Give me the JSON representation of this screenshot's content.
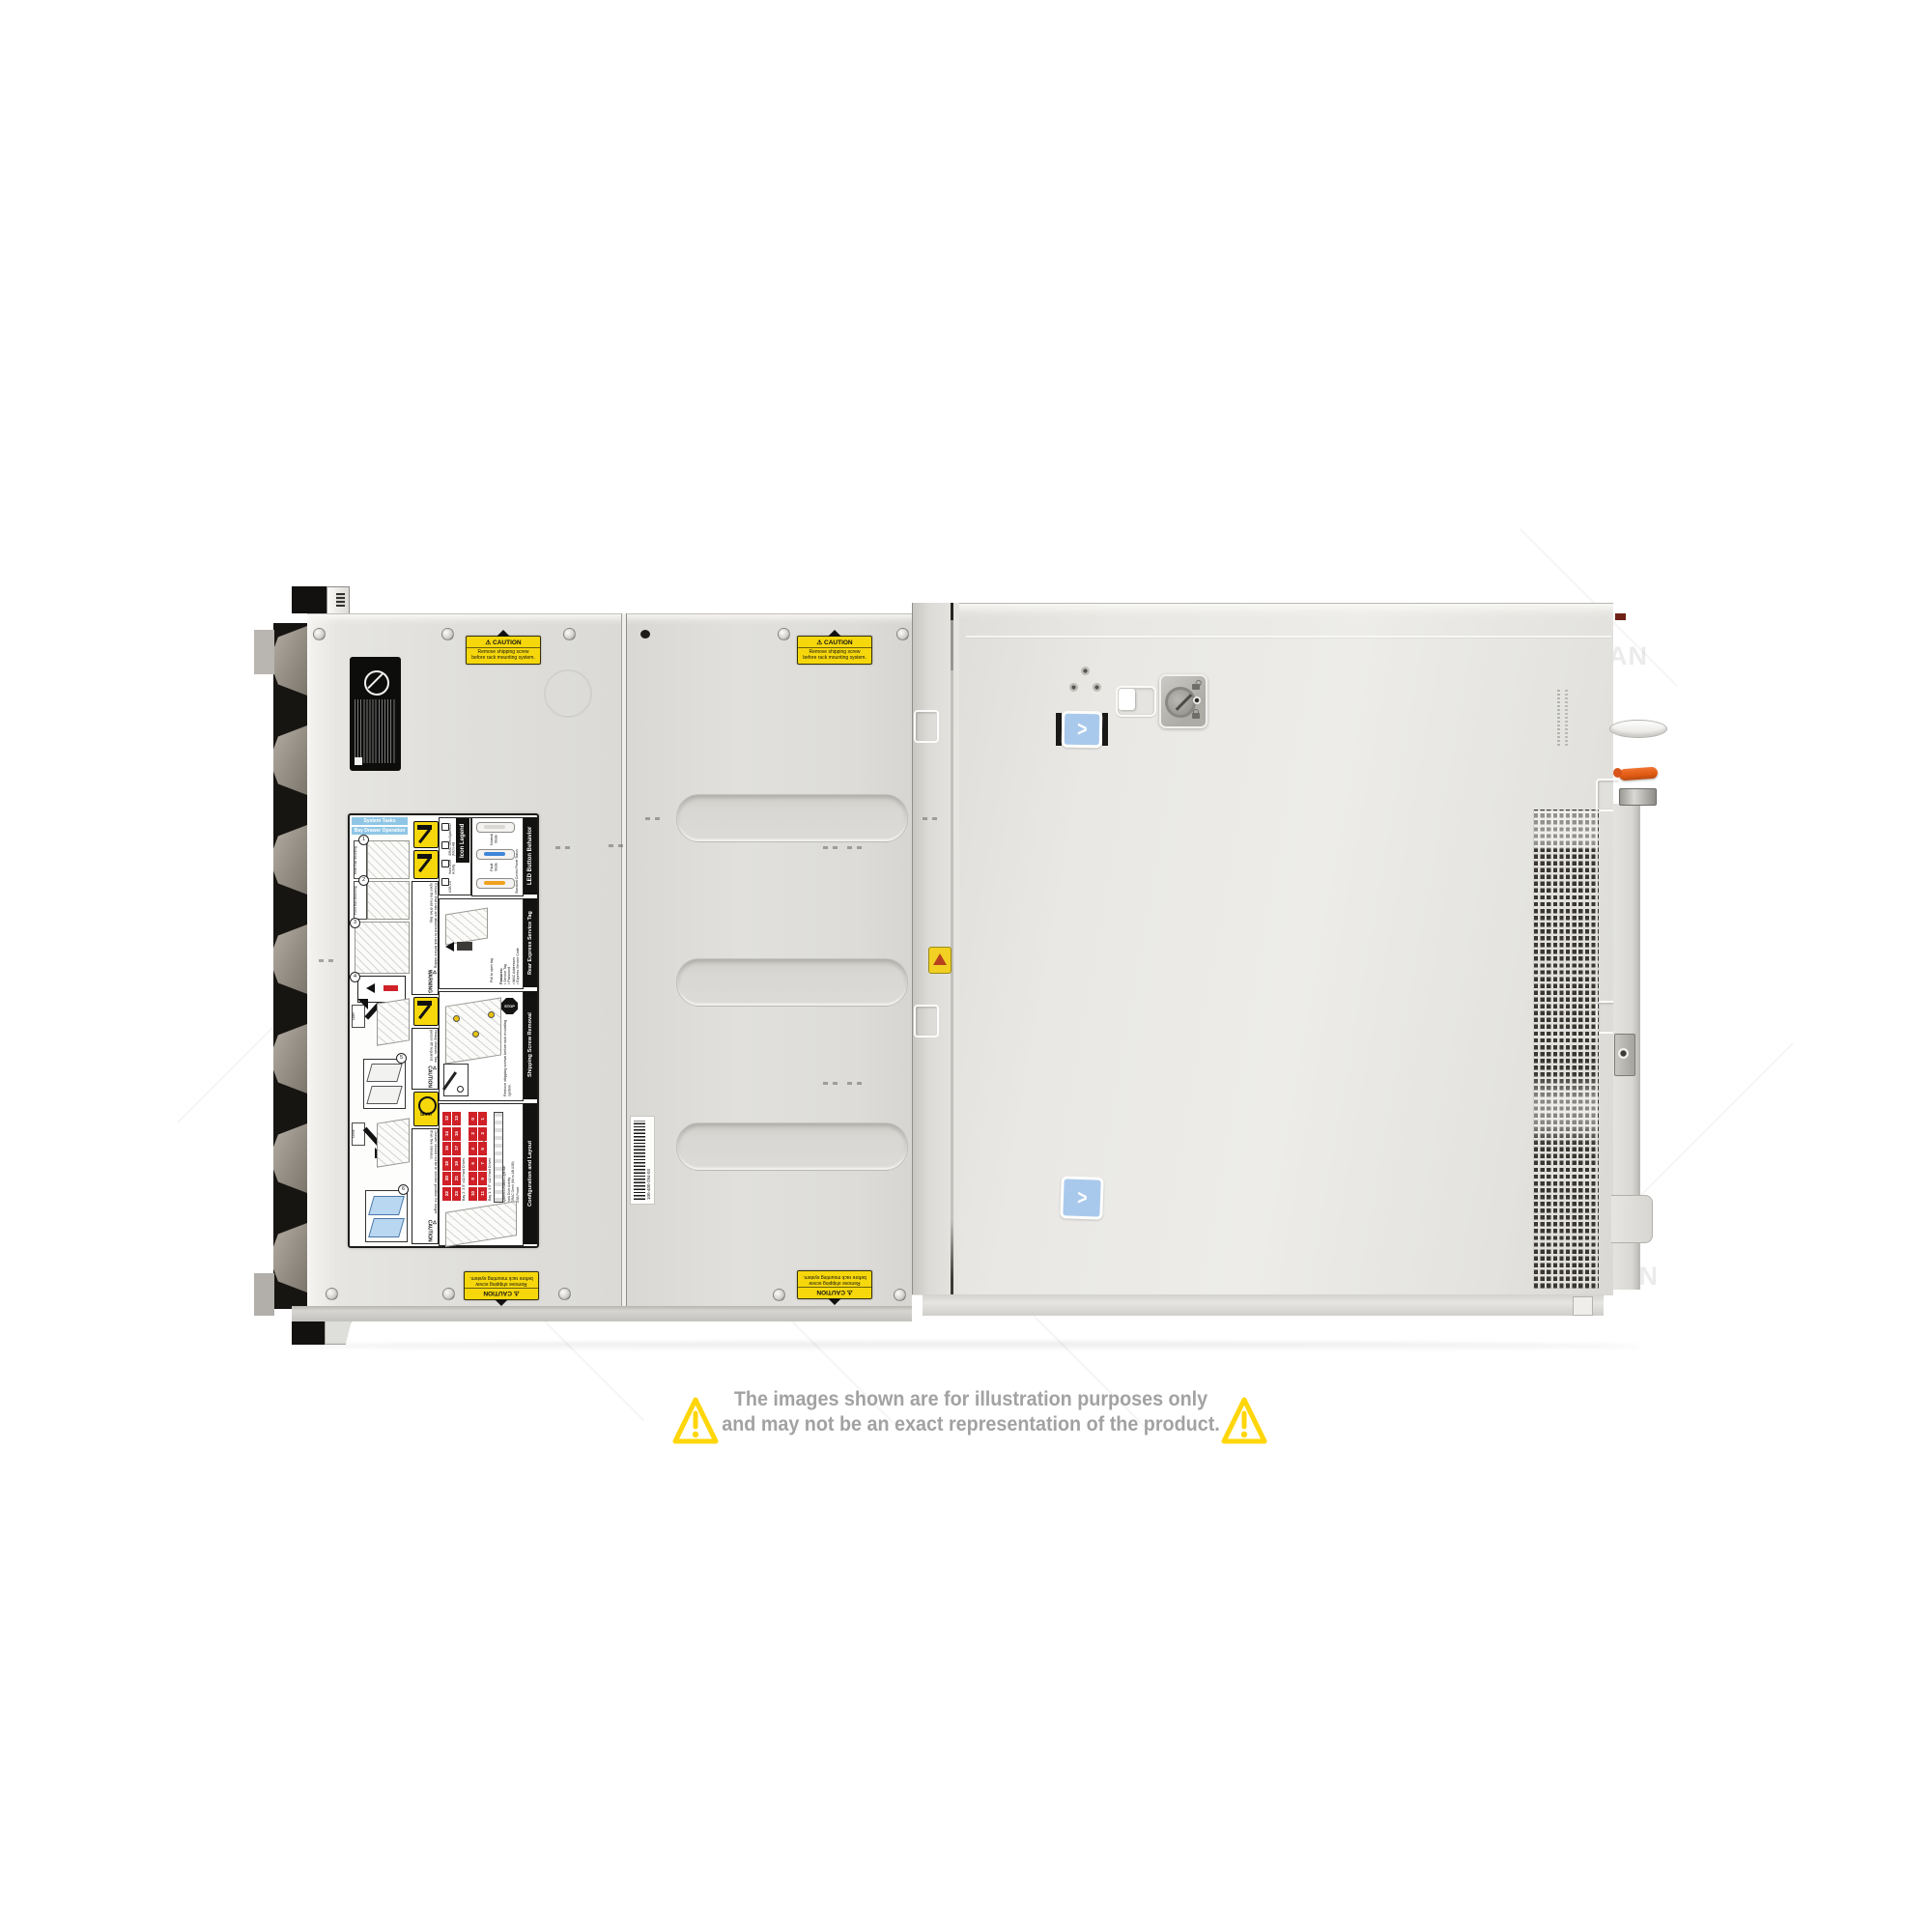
{
  "page": {
    "background": "#ffffff"
  },
  "watermark": {
    "text": "COMPAN"
  },
  "disclaimer": {
    "line1": "The images shown are for illustration purposes only",
    "line2": "and may not be an exact representation of the product."
  },
  "stickers": {
    "caution": {
      "glyph": "⚠",
      "title": "CAUTION",
      "line1": "Remove shipping screw",
      "line2": "before rack mounting system."
    },
    "blue_chevron": ">",
    "barcode_text": "100-400-294-03"
  },
  "labels": {
    "system_tasks": "System Tasks",
    "bay_drawer": "Bay Drawer Operation",
    "steps": [
      {
        "num": "1",
        "caption": "Rear Rail Mounting"
      },
      {
        "num": "2",
        "caption": "Front Rail Mounting"
      },
      {
        "num": "3",
        "caption": ""
      },
      {
        "num": "4",
        "caption": ""
      },
      {
        "num": "5",
        "caption": "Open"
      },
      {
        "num": "6",
        "caption": "Close"
      }
    ],
    "warning": {
      "glyph": "⚠",
      "title": "WARNING",
      "body": "Ensure that rails are attached to rack before sliding open the hard drive bay."
    },
    "caution_lift": {
      "glyph": "⚠",
      "title": "CAUTION",
      "body": "Heavy chassis. Two person lift required."
    },
    "caution_drawer": {
      "glyph": "⚠",
      "title": "CAUTION",
      "body": "Drawer should not be in service position for longer than five minutes."
    },
    "clock": "5min",
    "icon_legend": {
      "title": "Icon Legend",
      "items": [
        "System ID",
        "iDRAC Direct (Micro-AB USB)",
        "Hard Drive Activity",
        "USB 2.0"
      ]
    },
    "led": {
      "title": "LED Button Behavior",
      "subtitle": "Standard Control Panel Status",
      "state1": "Normal State",
      "state2": "Fault State"
    },
    "service_tag": {
      "title": "Rear Express Service Tag",
      "features_title": "Features:",
      "features": [
        "Service Tag",
        "Password",
        "MAC Addresses",
        "Express Service Code"
      ],
      "note": "Pull to open tag"
    },
    "shipping": {
      "title": "Shipping Screw Removal",
      "stop": "STOP",
      "body": "Remove shipping screws before rack mounting system."
    },
    "config": {
      "title": "Configuration and Layout",
      "front_view": "Front View",
      "bay2": "Bay 2: 3.5\" x12 Hard Drives",
      "bay1": "Bay 1: 3.5\" x12 Hard Drives",
      "bay2_cells": [
        12,
        13,
        14,
        15,
        16,
        17,
        18,
        19,
        20,
        21,
        22,
        23
      ],
      "bay1_cells": [
        0,
        1,
        2,
        3,
        4,
        5,
        6,
        7,
        8,
        9,
        10,
        11
      ],
      "side_labels": [
        "System ID/Status Light Bar",
        "Hard Drive Activity",
        "iDRAC Direct (Micro-AB USB)",
        "USB Power"
      ]
    }
  },
  "colors": {
    "accent_yellow": "#f6d70c",
    "bay_red": "#cf2127",
    "sticker_blue": "#a9c9ec",
    "warn_triangle": "#ffd60a",
    "led_blue": "#3f86d8",
    "led_amber": "#f0a01c",
    "orange_lever": "#e05a12",
    "disclaimer_gray": "#a2a2a2"
  }
}
